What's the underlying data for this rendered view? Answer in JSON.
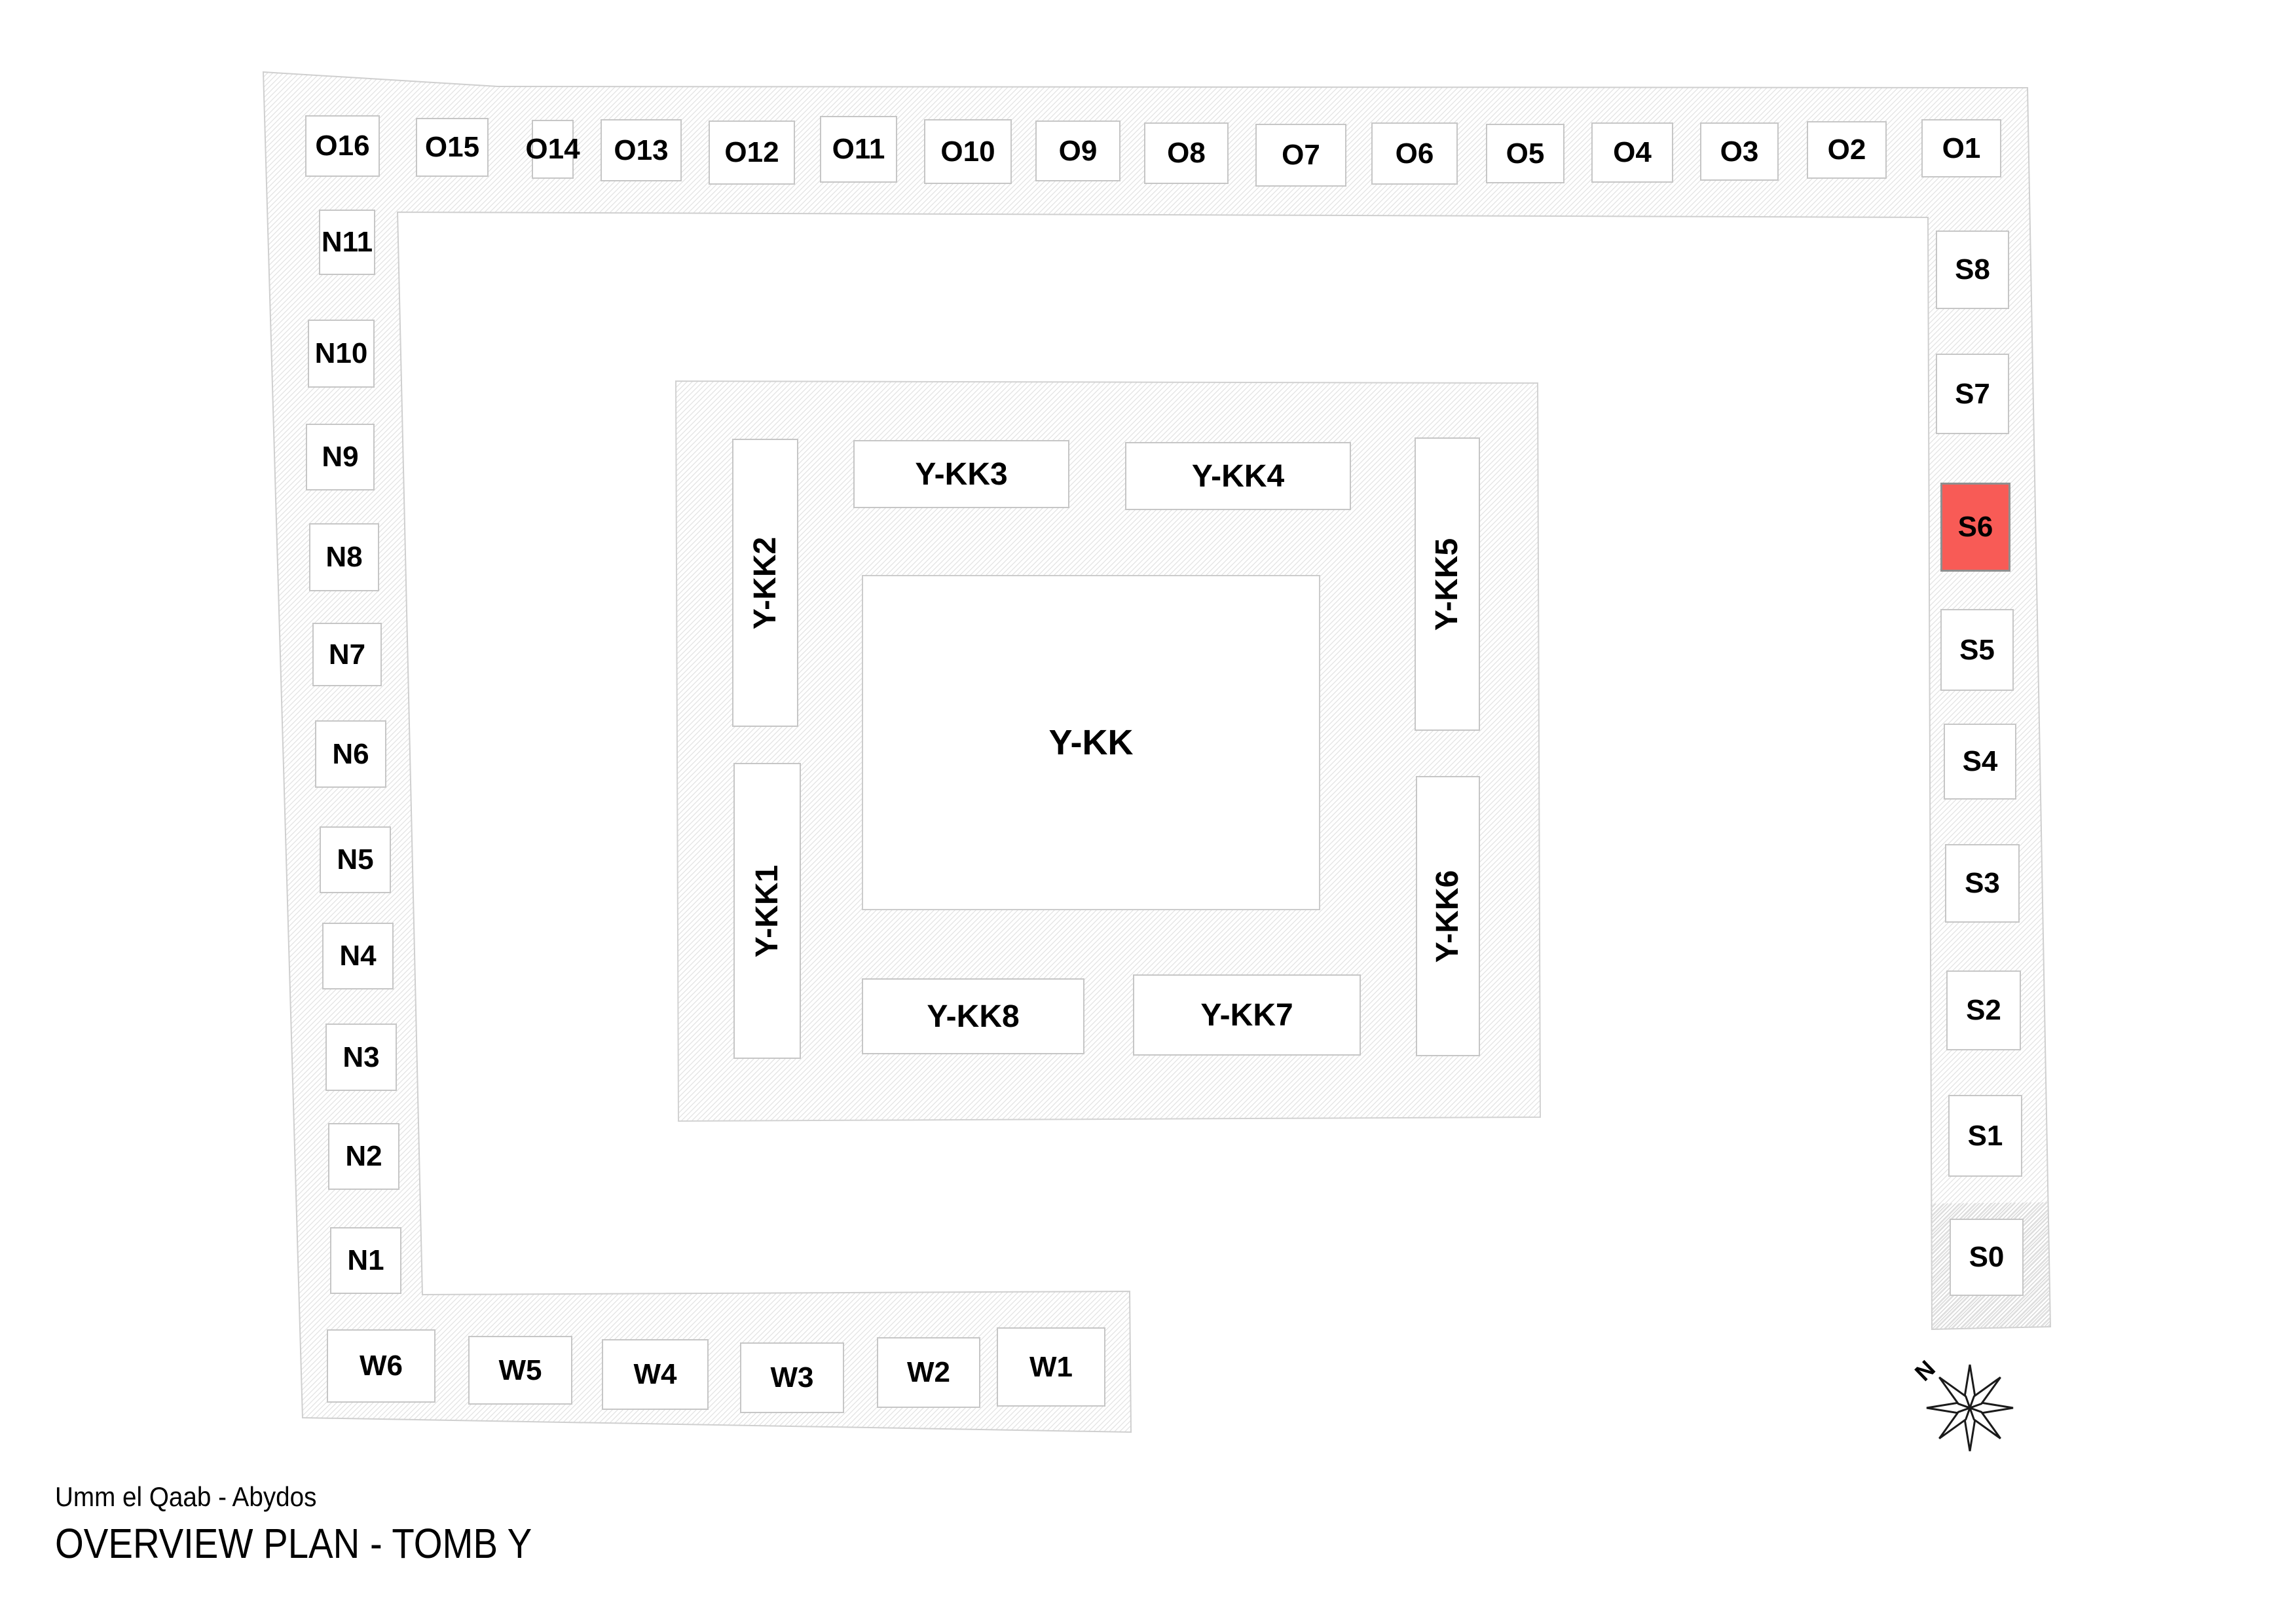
{
  "header": {
    "site_label": "Umm el Qaab - Abydos",
    "plan_title": "OVERVIEW PLAN - TOMB Y"
  },
  "compass": {
    "north_label": "N"
  },
  "colors": {
    "highlight_fill": "#F85B56",
    "hatch_line": "#E3E3E3",
    "hatch_line_dense": "#D7D7D7",
    "box_border": "#C6C6C6",
    "strip_outline": "#CFCFCF"
  },
  "chambers": {
    "highlighted": "S6",
    "o_row": [
      "O16",
      "O15",
      "O14",
      "O13",
      "O12",
      "O11",
      "O10",
      "O9",
      "O8",
      "O7",
      "O6",
      "O5",
      "O4",
      "O3",
      "O2",
      "O1"
    ],
    "n_column": [
      "N11",
      "N10",
      "N9",
      "N8",
      "N7",
      "N6",
      "N5",
      "N4",
      "N3",
      "N2",
      "N1"
    ],
    "w_row": [
      "W6",
      "W5",
      "W4",
      "W3",
      "W2",
      "W1"
    ],
    "s_column": [
      "S8",
      "S7",
      "S6",
      "S5",
      "S4",
      "S3",
      "S2",
      "S1",
      "S0"
    ],
    "inner_ring": [
      "Y-KK2",
      "Y-KK3",
      "Y-KK4",
      "Y-KK5",
      "Y-KK1",
      "Y-KK8",
      "Y-KK7",
      "Y-KK6"
    ],
    "central": "Y-KK"
  }
}
